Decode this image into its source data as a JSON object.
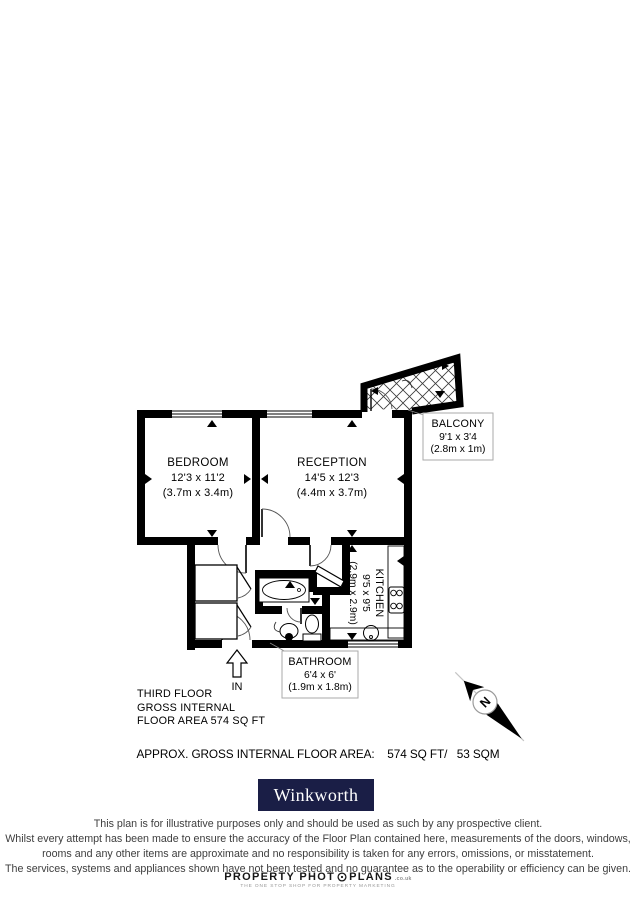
{
  "floor_plan": {
    "rooms": [
      {
        "id": "bedroom",
        "name": "BEDROOM",
        "dims_imperial": "12'3 x 11'2",
        "dims_metric": "(3.7m x 3.4m)"
      },
      {
        "id": "reception",
        "name": "RECEPTION",
        "dims_imperial": "14'5 x 12'3",
        "dims_metric": "(4.4m x 3.7m)"
      },
      {
        "id": "kitchen",
        "name": "KITCHEN",
        "dims_imperial": "9'5 x 9'5",
        "dims_metric": "(2.9m x 2.9m)"
      },
      {
        "id": "bathroom",
        "name": "BATHROOM",
        "dims_imperial": "6'4 x 6'",
        "dims_metric": "(1.9m x 1.8m)"
      },
      {
        "id": "balcony",
        "name": "BALCONY",
        "dims_imperial": "9'1 x 3'4",
        "dims_metric": "(2.8m x 1m)"
      }
    ],
    "entrance_label": "IN",
    "compass_label": "N",
    "wall_color": "#000000"
  },
  "floor_summary": {
    "lines": [
      "THIRD FLOOR",
      "GROSS INTERNAL",
      "FLOOR AREA 574 SQ FT"
    ]
  },
  "area_summary": {
    "text": "APPROX. GROSS INTERNAL FLOOR AREA:    574 SQ FT/   53 SQM"
  },
  "agent": {
    "name": "Winkworth",
    "brand_color": "#1a1e46"
  },
  "disclaimer": {
    "lines": [
      "This plan is for illustrative purposes only and should be used as such by any prospective client.",
      "Whilst every attempt has been made to ensure the accuracy of the Floor Plan contained here, measurements of the doors, windows,",
      "rooms and any other items are approximate and no responsibility is taken for any errors, omissions, or misstatement.",
      "The services, systems and appliances shown have not been tested and no guarantee as to the operability or efficiency can be given."
    ]
  },
  "footer_brand": {
    "name_left": "PROPERTY PHOT",
    "name_right": "PLANS",
    "domain_suffix": ".co.uk",
    "tagline": "THE ONE STOP SHOP FOR PROPERTY MARKETING"
  }
}
